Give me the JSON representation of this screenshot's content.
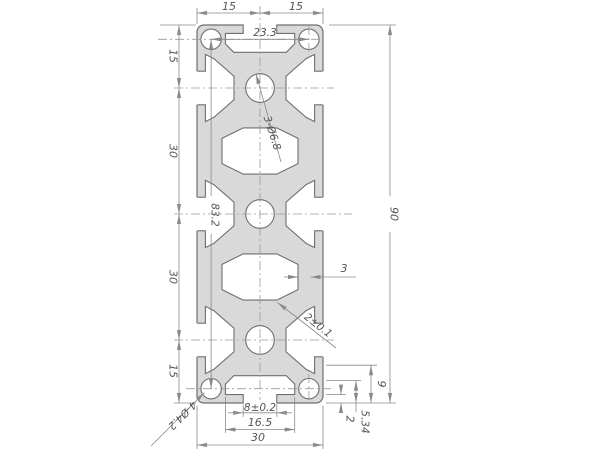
{
  "drawing": {
    "type": "technical-cross-section",
    "subject": "aluminum extrusion profile 30x90",
    "colors": {
      "background": "#ffffff",
      "profile_fill": "#d9d9d9",
      "outline": "#6f6f6f",
      "dimension_line": "#8a8a8a",
      "centerline": "#9a9a9a",
      "text": "#555555"
    },
    "dims": {
      "top_left_segment": "15",
      "top_right_segment": "15",
      "corner_hole_pitch_x": "23.3",
      "left_segment_1": "15",
      "left_segment_2": "30",
      "left_segment_3": "30",
      "left_segment_4": "15",
      "overall_height": "90",
      "corner_hole_span_y": "83.2",
      "center_holes_callout": "3-Ø6.8",
      "corner_holes_callout": "4-Ø4.2",
      "wall_thickness": "3",
      "web_thickness": "2±0.1",
      "slot_opening": "8±0.2",
      "slot_inner_width": "16.5",
      "overall_width": "30",
      "slot_depth": "9",
      "cavity_depth": "5.34",
      "lip_thickness": "2"
    }
  }
}
